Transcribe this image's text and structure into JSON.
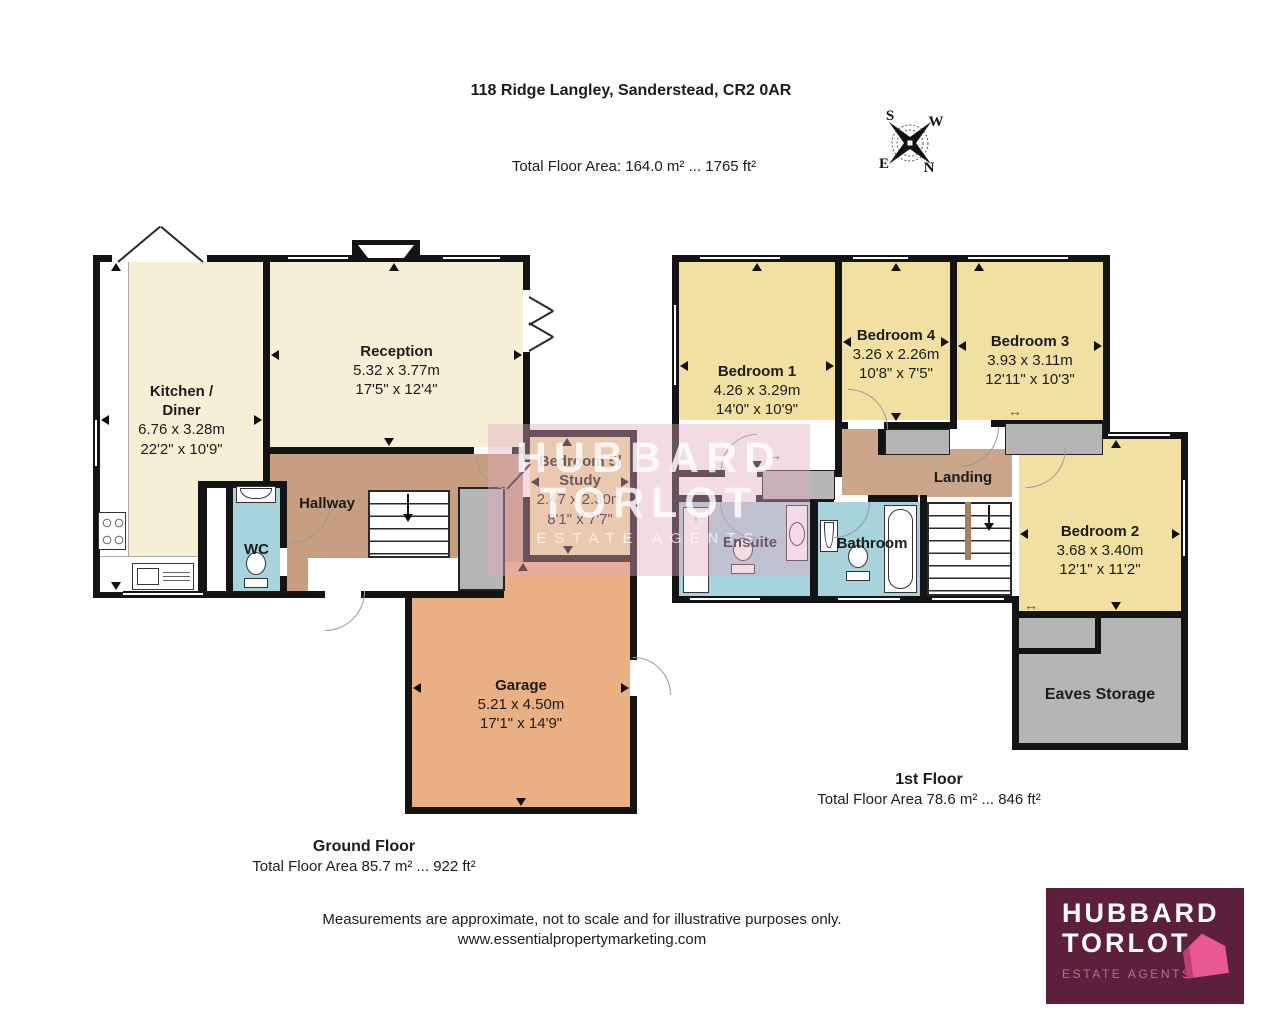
{
  "header": {
    "title": "118 Ridge Langley, Sanderstead, CR2 0AR",
    "total_area": "Total Floor Area: 164.0 m² ... 1765 ft²"
  },
  "compass": {
    "north": "N",
    "south": "S",
    "east": "E",
    "west": "W"
  },
  "rooms": {
    "kitchen": {
      "name": "Kitchen /",
      "name2": "Diner",
      "metric": "6.76 x 3.28m",
      "imperial": "22'2\" x 10'9\""
    },
    "reception": {
      "name": "Reception",
      "metric": "5.32 x 3.77m",
      "imperial": "17'5\" x 12'4\""
    },
    "hallway": {
      "name": "Hallway"
    },
    "wc": {
      "name": "WC"
    },
    "bedroom5": {
      "name": "Bedroom 5/",
      "name2": "Study",
      "metric": "2.47 x 2.30m",
      "imperial": "8'1\" x 7'7\""
    },
    "garage": {
      "name": "Garage",
      "metric": "5.21 x 4.50m",
      "imperial": "17'1\" x 14'9\""
    },
    "bedroom1": {
      "name": "Bedroom 1",
      "metric": "4.26 x 3.29m",
      "imperial": "14'0\" x 10'9\""
    },
    "bedroom4": {
      "name": "Bedroom 4",
      "metric": "3.26 x 2.26m",
      "imperial": "10'8\" x 7'5\""
    },
    "bedroom3": {
      "name": "Bedroom 3",
      "metric": "3.93 x 3.11m",
      "imperial": "12'11\" x 10'3\""
    },
    "bedroom2": {
      "name": "Bedroom 2",
      "metric": "3.68 x 3.40m",
      "imperial": "12'1\" x 11'2\""
    },
    "landing": {
      "name": "Landing"
    },
    "ensuite": {
      "name": "Ensuite"
    },
    "bathroom": {
      "name": "Bathroom"
    },
    "eaves": {
      "name": "Eaves Storage"
    }
  },
  "floors": {
    "ground": {
      "label": "Ground Floor",
      "area": "Total Floor Area 85.7 m² ... 922 ft²"
    },
    "first": {
      "label": "1st Floor",
      "area": "Total Floor Area 78.6 m² ... 846 ft²"
    }
  },
  "footer": {
    "disclaimer": "Measurements are approximate, not to scale and for illustrative purposes only.",
    "website": "www.essentialpropertymarketing.com"
  },
  "logo": {
    "line1": "HUBBARD",
    "line2": "TORLOT",
    "tagline": "ESTATE AGENTS"
  },
  "watermark": {
    "line1": "HUBBARD",
    "line2": "TORLOT",
    "tagline": "ESTATE AGENTS"
  },
  "colors": {
    "cream": "#F6EFD6",
    "gold": "#F2E0A2",
    "brown": "#C79F80",
    "brown_light": "#CBA68A",
    "blue": "#A7D3DD",
    "orange": "#EAAF82",
    "gray": "#B5B5B5",
    "wall": "#141414",
    "logo_bg": "#5C203D",
    "logo_pink": "#E85992",
    "logo_pink_dark": "#C23C72",
    "logo_tag": "#B96F8E",
    "watermark_tint": "rgba(224,170,193,0.42)"
  }
}
